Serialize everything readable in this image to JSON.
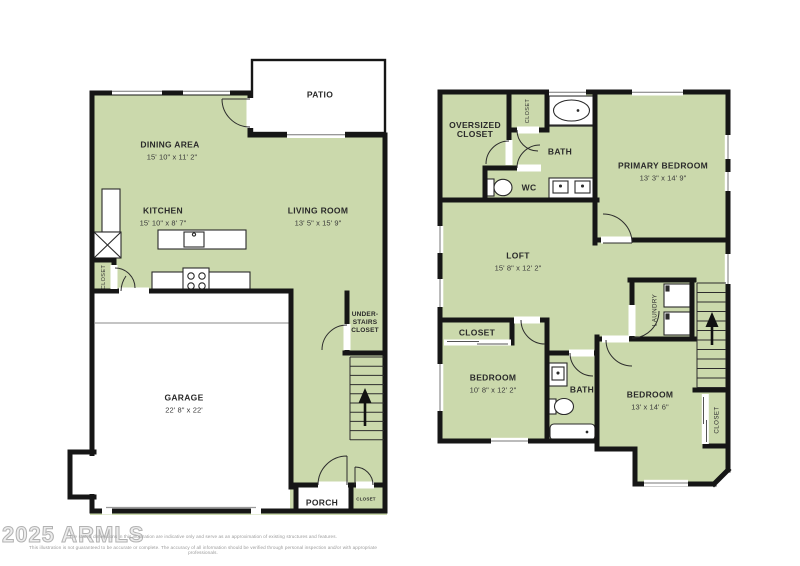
{
  "colors": {
    "room_fill": "#cbd9ac",
    "wall": "#161616",
    "background": "#ffffff"
  },
  "floor1": {
    "patio": {
      "label": "PATIO"
    },
    "dining": {
      "label": "DINING AREA",
      "dims": "15' 10\" x 11' 2\""
    },
    "kitchen": {
      "label": "KITCHEN",
      "dims": "15' 10\" x 8' 7\""
    },
    "living": {
      "label": "LIVING ROOM",
      "dims": "13' 5\" x 15' 9\""
    },
    "garage": {
      "label": "GARAGE",
      "dims": "22' 8\" x 22'"
    },
    "under_stairs_closet": {
      "label": "UNDER-\nSTAIRS\nCLOSET"
    },
    "entry_closet": {
      "label": "CLOSET"
    },
    "porch": {
      "label": "PORCH"
    },
    "porch_closet": {
      "label": "CLOSET"
    }
  },
  "floor2": {
    "oversized_closet": {
      "label": "OVERSIZED\nCLOSET"
    },
    "top_closet": {
      "label": "CLOSET"
    },
    "bath_top": {
      "label": "BATH"
    },
    "wc": {
      "label": "WC"
    },
    "primary_bedroom": {
      "label": "PRIMARY BEDROOM",
      "dims": "13' 3\" x 14' 9\""
    },
    "loft": {
      "label": "LOFT",
      "dims": "15' 8\" x 12' 2\""
    },
    "laundry": {
      "label": "LAUNDRY"
    },
    "bedroom_closet": {
      "label": "CLOSET"
    },
    "bedroom_left": {
      "label": "BEDROOM",
      "dims": "10' 8\" x 12' 2\""
    },
    "bath_middle": {
      "label": "BATH"
    },
    "bedroom_right": {
      "label": "BEDROOM",
      "dims": "13' x 14' 6\""
    },
    "right_closet": {
      "label": "CLOSET"
    }
  },
  "footer": {
    "watermark": "2025 ARMLS",
    "disclaimer_line1": "The stated dimensions in this illustration are indicative only and serve as an approximation of existing structures and features.",
    "disclaimer_line2": "This illustration is not guaranteed to be accurate or complete. The accuracy of all information should be verified through personal inspection and/or with appropriate professionals."
  }
}
